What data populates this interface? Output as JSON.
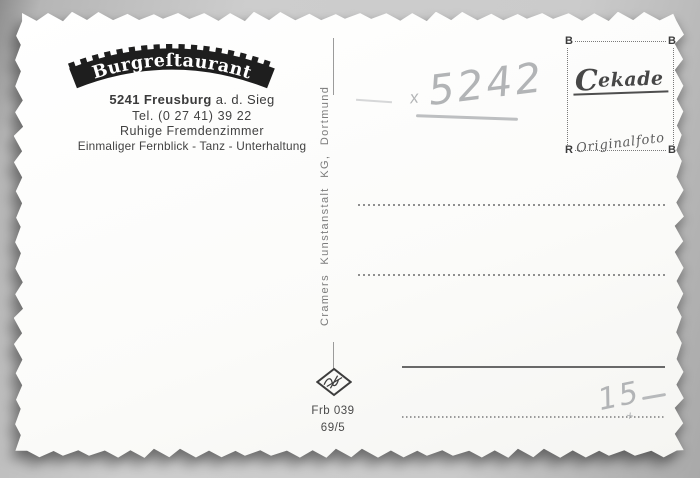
{
  "postcard": {
    "header": {
      "logo_text": "Burgreſtaurant",
      "address_line1_bold": "5241 Freusburg",
      "address_line1_rest": "a. d. Sieg",
      "address_line2": "Tel. (0 27 41) 39 22",
      "address_line3": "Ruhige Fremdenzimmer",
      "address_line4": "Einmaliger Fernblick - Tanz - Unterhaltung"
    },
    "publisher_vertical": "Cramers Kunstanstalt KG, Dortmund",
    "stamp_box": {
      "corner_tl": "B",
      "corner_tr": "B",
      "corner_bl": "R",
      "corner_br": "B",
      "brand_initial": "C",
      "brand_rest": "ekade",
      "subtitle": "Originalfoto"
    },
    "handwriting": {
      "x_mark": "x",
      "photo_number": "5242",
      "price": "15",
      "plus_mark": "+"
    },
    "footer": {
      "order_number": "Frb 039",
      "date_code": "69/5"
    },
    "icons": {
      "logo_banner": "castle-battlement-arch-banner-icon",
      "diamond_logo": "printer-diamond-logo-icon"
    },
    "colors": {
      "card": "#fcfcfb",
      "print_dark": "#2e2e2e",
      "print_gray": "#4a4a4a",
      "pencil": "#b3b5b7",
      "background_gray": "#bfbfbf",
      "line_gray": "#8f8f8f"
    }
  }
}
